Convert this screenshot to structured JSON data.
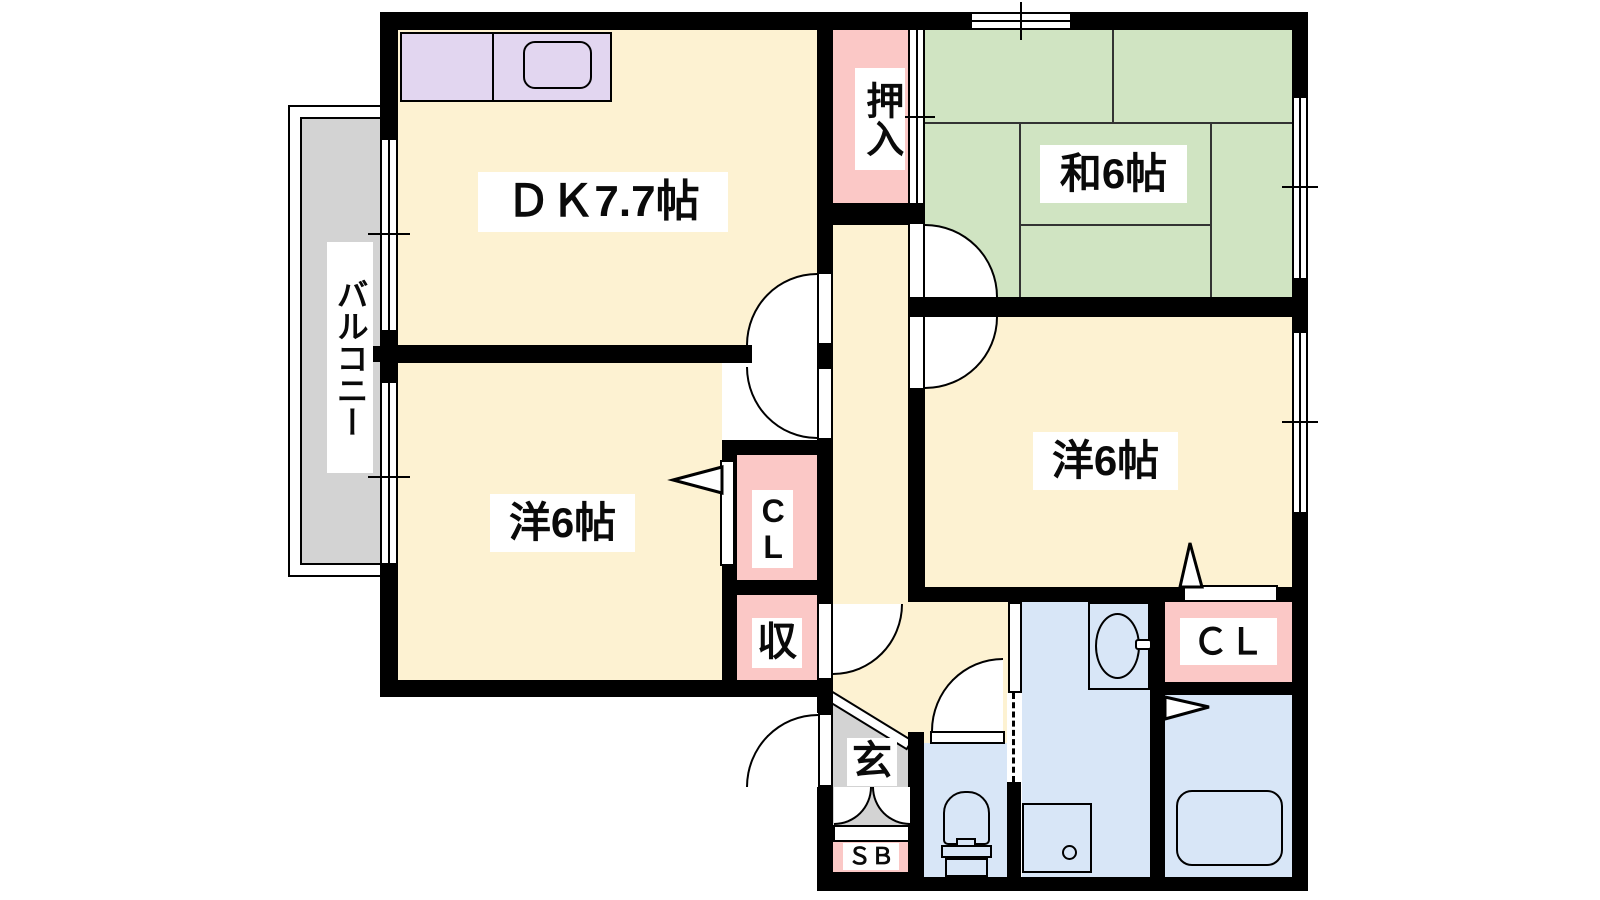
{
  "floorplan": {
    "type": "apartment-floor-plan",
    "rooms": {
      "dk": {
        "label": "ＤＫ7.7帖"
      },
      "washitsu": {
        "label": "和6帖"
      },
      "youshitsu_left": {
        "label": "洋6帖"
      },
      "youshitsu_right": {
        "label": "洋6帖"
      },
      "balcony": {
        "label": "バルコニー"
      },
      "oshiire": {
        "label": "押入"
      },
      "cl_left": {
        "label": "CL"
      },
      "cl_right": {
        "label": "ＣＬ"
      },
      "shuunou": {
        "label": "収"
      },
      "genkan": {
        "label": "玄"
      },
      "shoebox": {
        "label": "ＳＢ"
      }
    },
    "fixtures": [
      "kitchen-counter-icon",
      "kitchen-sink-icon",
      "vanity-basin-icon",
      "toilet-icon",
      "bathtub-icon",
      "washer-pan-icon"
    ],
    "colors": {
      "wall": "#000000",
      "room_cream": "#fdf2d2",
      "tatami_green": "#d0e4c2",
      "closet_pink": "#fbc8c6",
      "kitchen_lavender": "#e2d6f0",
      "water_blue": "#d8e6f7",
      "balcony_gray": "#d3d3d3",
      "background": "#ffffff"
    }
  }
}
